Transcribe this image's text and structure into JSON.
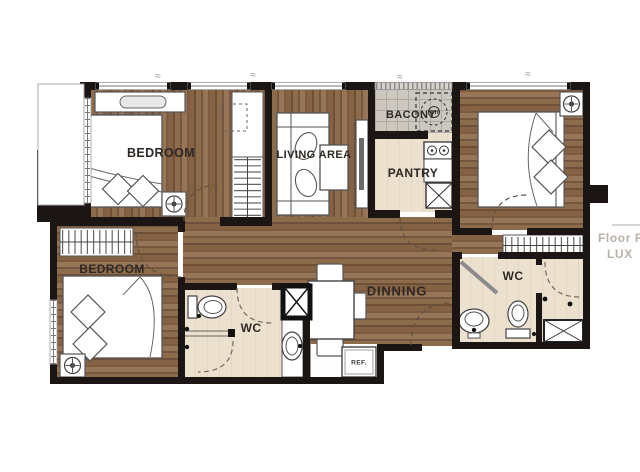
{
  "plan": {
    "title": "apartment-floor-plan",
    "rooms": {
      "bedroom1": {
        "label": "BEDROOM"
      },
      "bedroom2": {
        "label": "BEDROOM"
      },
      "bedroom3": {
        "label": ""
      },
      "living": {
        "label": "LIVING AREA"
      },
      "balcony": {
        "label": "BACONY"
      },
      "pantry": {
        "label": "PANTRY"
      },
      "dining": {
        "label": "DINNING"
      },
      "wc1": {
        "label": "WC"
      },
      "wc2": {
        "label": "WC"
      }
    },
    "appliances": {
      "fridge_label": "REF.",
      "washer_label": "WH"
    },
    "watermark": {
      "line1": "Floor P",
      "line2": "LUX"
    },
    "dimension_marks": "≈",
    "colors": {
      "wall": "#1b1613",
      "wood": "#8d6c4c",
      "tile_floor": "#ece0ce",
      "balcony_floor": "#ccc7bf",
      "furniture_line": "#4d4d4d",
      "watermark_text": "#b8b1a7"
    }
  }
}
